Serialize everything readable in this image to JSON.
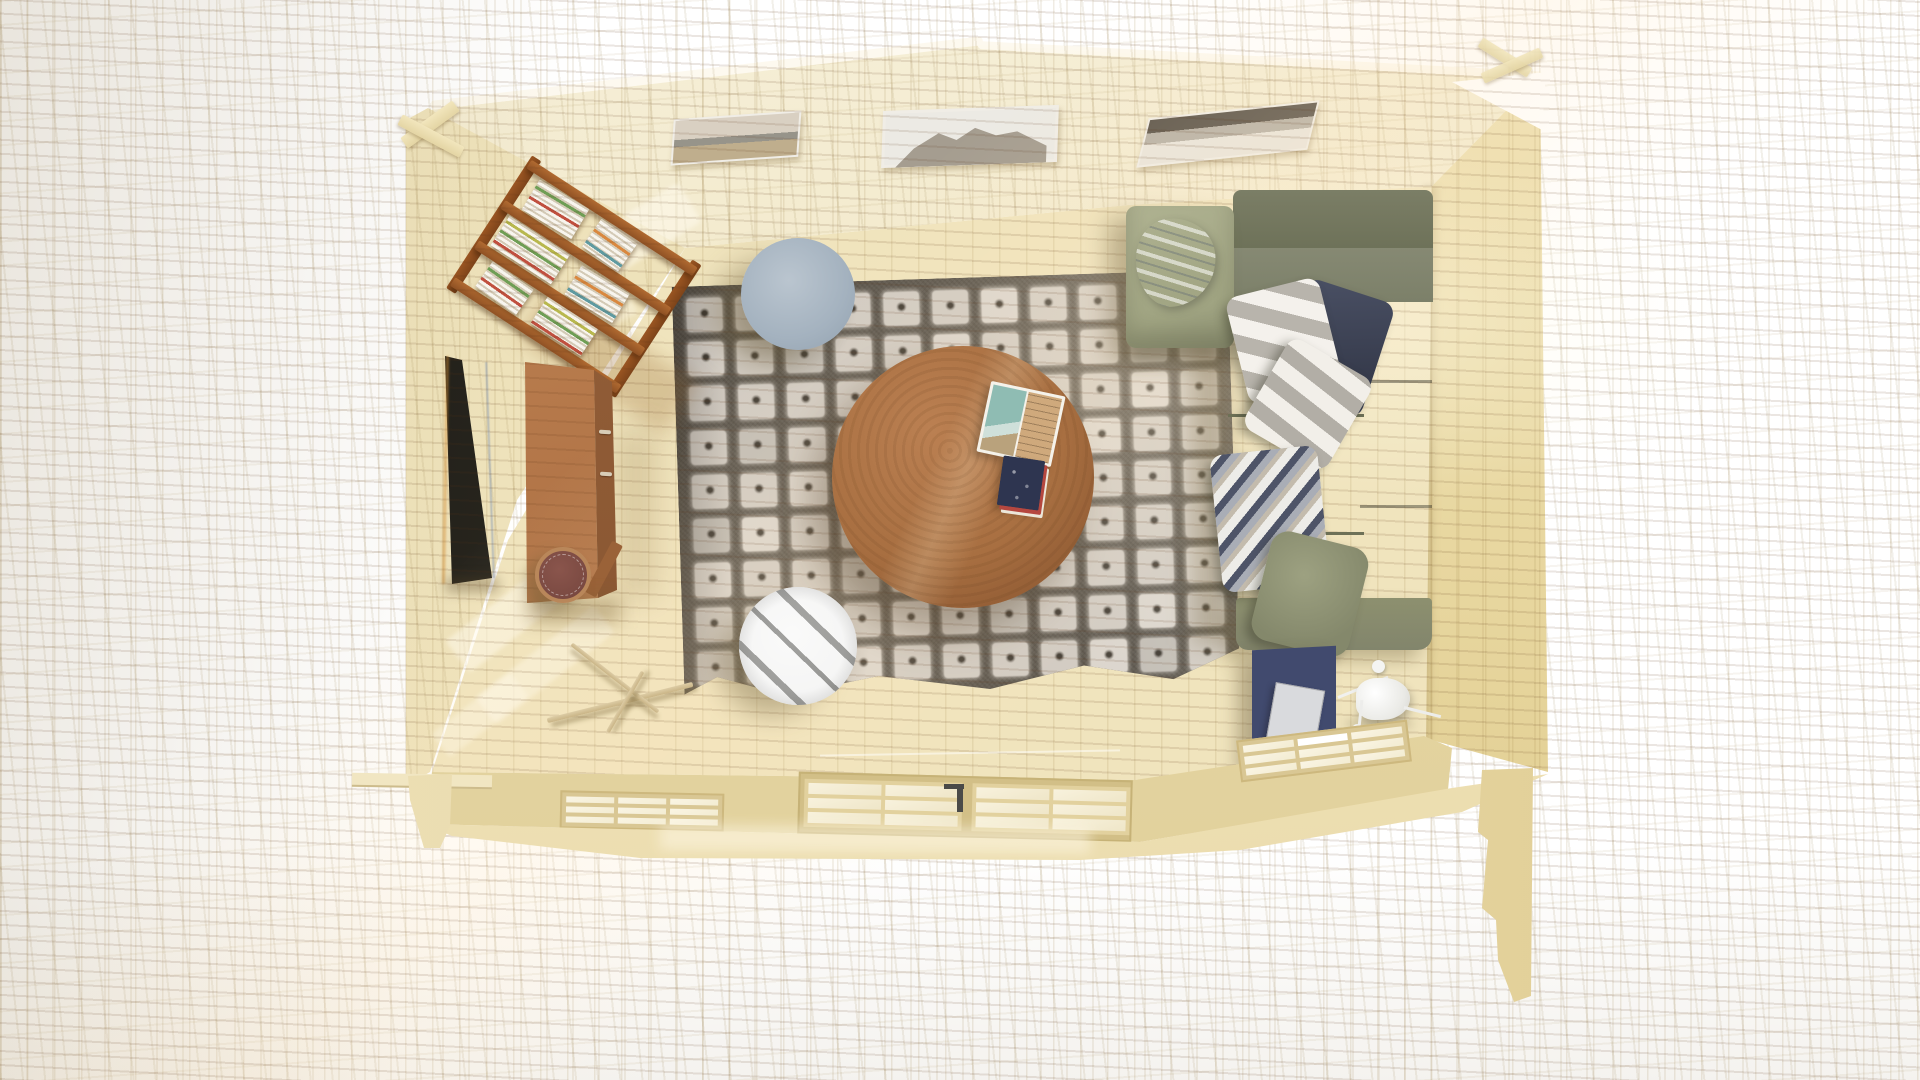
{
  "scene": {
    "kind": "3d-interior-render",
    "view": "top-down-cutaway",
    "subject": "wooden-cabin-living-room",
    "background_color": "#ffffff"
  },
  "palette": {
    "wall_wood": "#efe4bf",
    "roof_wood": "#f4edd5",
    "right_wall_wood": "#e7d69f",
    "floor_wood": "#f0e4bd",
    "apron_wood": "#f2e7c6",
    "rug_base": "#59534a",
    "rug_square": "#d1cbc3",
    "rug_dot": "#403a32",
    "coffee_table_wood": "#a86f41",
    "bookshelf_wood": "#a95f2b",
    "desk_wood": "#b07346",
    "sofa_body": "#81846c",
    "sofa_back": "#6d7158",
    "sofa_chaise": "#a7aa8a",
    "pillow_navy": "#3d4354",
    "pillow_stripe_light": "#f4f1ec",
    "pillow_stripe_dark": "#b8b4ac",
    "pillow_olive": "#8e9277",
    "chevron_white": "#edece8",
    "chevron_navy": "#4e5468",
    "chevron_gray": "#a9adb6",
    "chevron_tan": "#c3bbad",
    "blanket_denim": "#b4c1ce",
    "pouf_top": "#a9b7c3",
    "pouf_bottom": "#cbcbc8",
    "stool_seat": "#7b4a42",
    "tv_screen": "#1c1a15",
    "side_table": "#3c4366",
    "tablet": "#d9dadd",
    "lamp": "#f2f2f0",
    "window_pane": "#f8f3e0",
    "window_frame": "#d9c794",
    "door_handle": "#4a4a48"
  },
  "rug": {
    "pattern": {
      "rows": 9,
      "cols": 11,
      "count": 99
    }
  },
  "windows": {
    "left": {
      "rows": 3,
      "cols": 3,
      "count": 9
    },
    "right": {
      "rows": 3,
      "cols": 3,
      "count": 9
    }
  },
  "door": {
    "leaves": 2,
    "panes_per_leaf": {
      "rows": 3,
      "cols": 2,
      "count": 6
    }
  },
  "pictures": {
    "count": 3,
    "items": [
      {
        "name": "seascape"
      },
      {
        "name": "snow-mountain"
      },
      {
        "name": "winter-panorama"
      }
    ]
  },
  "bookshelf": {
    "rails": 4,
    "book_stacks": 6
  },
  "sofa": {
    "sections": [
      "chaise",
      "top-seat",
      "right-seat"
    ],
    "pillows": [
      "navy",
      "striped",
      "striped",
      "chevron",
      "olive"
    ],
    "throw": "denim-blanket"
  },
  "tables": {
    "coffee_table": {
      "shape": "round",
      "items": [
        "open-magazine",
        "book-stack"
      ]
    },
    "side_table": {
      "items": [
        "tablet"
      ]
    }
  },
  "seating_extras": {
    "poufs": 2,
    "stool": 1
  },
  "lighting": {
    "floor_lamp": 1,
    "sunlight_patches": true
  }
}
